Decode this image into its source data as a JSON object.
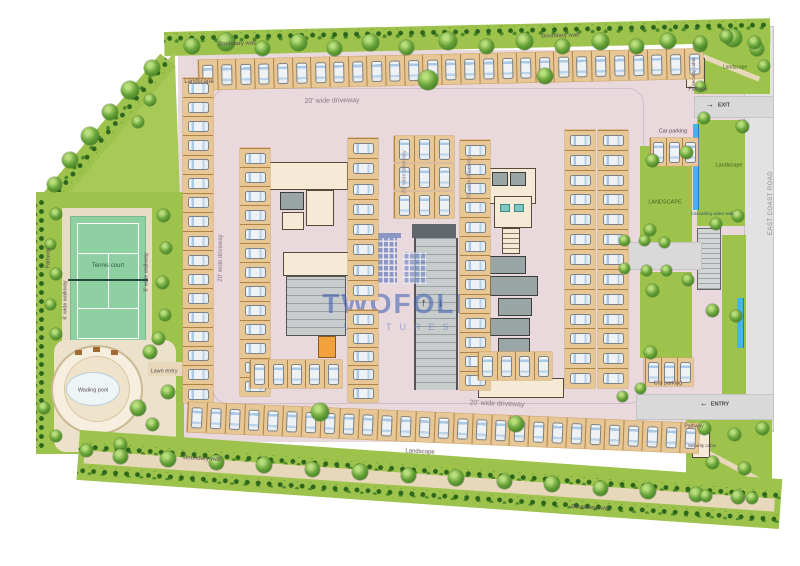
{
  "watermark": {
    "brand": "TWOFOLD",
    "sub": "VENTURES",
    "color": "#3a5db0"
  },
  "road": {
    "label": "EAST COAST ROAD"
  },
  "icons": {
    "arrow_up": "↑",
    "arrow_down": "↓",
    "arrow_right": "→",
    "arrow_left": "←",
    "tree": "tree-icon",
    "car": "car-icon"
  },
  "colors": {
    "paving": "#e9d8dc",
    "stall": "#e7c795",
    "landscape": "#9dc34d",
    "tenniscourt": "#8ed0a2",
    "water": "#46b4e4",
    "building": "#f5ead6",
    "road": "#d9d9d9",
    "watermark": "#3a5db0"
  },
  "labels": [
    {
      "t": "Boundary wall",
      "x": 237,
      "y": 44,
      "r": -1.5
    },
    {
      "t": "Boundary wall",
      "x": 560,
      "y": 36,
      "r": -1.5
    },
    {
      "t": "Landscape",
      "x": 199,
      "y": 82,
      "r": 0
    },
    {
      "t": "20' wide driveway",
      "x": 332,
      "y": 101,
      "r": -1,
      "s": 7,
      "c": "#8a7a80"
    },
    {
      "t": "20' wide driveway",
      "x": 221,
      "y": 258,
      "r": -90,
      "s": 6,
      "c": "#8a7a80"
    },
    {
      "t": "20' wide driveway",
      "x": 405,
      "y": 172,
      "r": -90,
      "s": 5.5,
      "c": "#8a7a80"
    },
    {
      "t": "20' wide driveway",
      "x": 470,
      "y": 178,
      "r": -90,
      "s": 5.5,
      "c": "#8a7a80"
    },
    {
      "t": "20' wide driveway",
      "x": 497,
      "y": 404,
      "r": 2,
      "s": 7,
      "c": "#8a7a80"
    },
    {
      "t": "Pathway",
      "x": 49,
      "y": 258,
      "r": -90,
      "s": 5.5
    },
    {
      "t": "6' wide walkway",
      "x": 66,
      "y": 300,
      "r": -90,
      "s": 5.5
    },
    {
      "t": "6' wide walkway",
      "x": 147,
      "y": 272,
      "r": -90,
      "s": 5.5
    },
    {
      "t": "Tennis court",
      "x": 108,
      "y": 266,
      "r": 0,
      "s": 6,
      "c": "#2f5d46"
    },
    {
      "t": "Wading pool",
      "x": 93,
      "y": 391,
      "r": 0,
      "s": 5.5
    },
    {
      "t": "Lawn entry",
      "x": 164,
      "y": 372,
      "r": 0,
      "s": 5.5
    },
    {
      "t": "Boundary wall",
      "x": 202,
      "y": 459,
      "r": 3
    },
    {
      "t": "Boundary wall",
      "x": 590,
      "y": 508,
      "r": 3
    },
    {
      "t": "Landscape",
      "x": 420,
      "y": 452,
      "r": 3
    },
    {
      "t": "LANDSCAPE",
      "x": 665,
      "y": 203,
      "r": 0,
      "s": 5.5,
      "c": "#3f6220"
    },
    {
      "t": "Landscape",
      "x": 729,
      "y": 166,
      "r": 0,
      "s": 5.5,
      "c": "#3f6220"
    },
    {
      "t": "Cascading water wall",
      "x": 712,
      "y": 214,
      "r": 0,
      "s": 4.5,
      "c": "#33606f"
    },
    {
      "t": "Car parking",
      "x": 673,
      "y": 132,
      "r": 0,
      "s": 5.5
    },
    {
      "t": "Car parking",
      "x": 668,
      "y": 384,
      "r": 0,
      "s": 5.5
    },
    {
      "t": "Pathway",
      "x": 698,
      "y": 90,
      "r": 0,
      "s": 5
    },
    {
      "t": "Pathway",
      "x": 694,
      "y": 427,
      "r": 0,
      "s": 5
    },
    {
      "t": "Security cabin",
      "x": 694,
      "y": 72,
      "r": -90,
      "s": 4.5
    },
    {
      "t": "Security cabin",
      "x": 702,
      "y": 446,
      "r": 0,
      "s": 4.5
    },
    {
      "t": "EXIT",
      "x": 724,
      "y": 106,
      "r": 0,
      "s": 5.5,
      "c": "#444",
      "b": 1
    },
    {
      "t": "ENTRY",
      "x": 720,
      "y": 405,
      "r": 0,
      "s": 5.5,
      "c": "#444",
      "b": 1
    },
    {
      "t": "Landscape",
      "x": 735,
      "y": 68,
      "r": 0,
      "s": 5,
      "c": "#3f6220"
    }
  ],
  "parking_rows": [
    {
      "x": 198,
      "y": 60,
      "w": 505,
      "h": 30,
      "rot": -1.3,
      "n": 27,
      "dir": "v"
    },
    {
      "x": 183,
      "y": 78,
      "w": 30,
      "h": 325,
      "rot": 0,
      "n": 17,
      "dir": "h"
    },
    {
      "x": 240,
      "y": 148,
      "w": 30,
      "h": 248,
      "rot": 0,
      "n": 13,
      "dir": "h"
    },
    {
      "x": 348,
      "y": 138,
      "w": 30,
      "h": 162,
      "rot": 0,
      "n": 8,
      "dir": "h"
    },
    {
      "x": 348,
      "y": 310,
      "w": 30,
      "h": 92,
      "rot": 0,
      "n": 5,
      "dir": "h"
    },
    {
      "x": 394,
      "y": 136,
      "w": 60,
      "h": 26,
      "rot": 0,
      "n": 3,
      "dir": "v"
    },
    {
      "x": 394,
      "y": 164,
      "w": 60,
      "h": 26,
      "rot": 0,
      "n": 3,
      "dir": "v"
    },
    {
      "x": 394,
      "y": 192,
      "w": 60,
      "h": 26,
      "rot": 0,
      "n": 3,
      "dir": "v"
    },
    {
      "x": 460,
      "y": 140,
      "w": 30,
      "h": 250,
      "rot": 0,
      "n": 13,
      "dir": "h"
    },
    {
      "x": 565,
      "y": 130,
      "w": 30,
      "h": 258,
      "rot": 0,
      "n": 13,
      "dir": "h"
    },
    {
      "x": 598,
      "y": 130,
      "w": 30,
      "h": 258,
      "rot": 0,
      "n": 13,
      "dir": "h"
    },
    {
      "x": 250,
      "y": 360,
      "w": 92,
      "h": 28,
      "rot": 0,
      "n": 5,
      "dir": "v"
    },
    {
      "x": 478,
      "y": 352,
      "w": 74,
      "h": 28,
      "rot": 0,
      "n": 4,
      "dir": "v"
    },
    {
      "x": 650,
      "y": 138,
      "w": 48,
      "h": 28,
      "rot": 0,
      "n": 3,
      "dir": "v"
    },
    {
      "x": 645,
      "y": 358,
      "w": 48,
      "h": 28,
      "rot": 0,
      "n": 3,
      "dir": "v"
    },
    {
      "x": 188,
      "y": 402,
      "w": 512,
      "h": 30,
      "rot": 2.4,
      "n": 27,
      "dir": "v"
    }
  ],
  "trees": [
    [
      192,
      46,
      16
    ],
    [
      226,
      42,
      18
    ],
    [
      262,
      48,
      15
    ],
    [
      298,
      42,
      17
    ],
    [
      334,
      48,
      15
    ],
    [
      370,
      42,
      17
    ],
    [
      406,
      47,
      15
    ],
    [
      448,
      41,
      18
    ],
    [
      486,
      46,
      15
    ],
    [
      524,
      41,
      17
    ],
    [
      562,
      46,
      15
    ],
    [
      600,
      41,
      17
    ],
    [
      636,
      46,
      15
    ],
    [
      668,
      41,
      16
    ],
    [
      700,
      45,
      14
    ],
    [
      733,
      38,
      18
    ],
    [
      757,
      49,
      14
    ],
    [
      428,
      80,
      20
    ],
    [
      545,
      76,
      16
    ],
    [
      152,
      68,
      16
    ],
    [
      130,
      90,
      18
    ],
    [
      110,
      112,
      16
    ],
    [
      90,
      136,
      18
    ],
    [
      70,
      160,
      16
    ],
    [
      54,
      184,
      15
    ],
    [
      150,
      100,
      12
    ],
    [
      138,
      122,
      12
    ],
    [
      163,
      215,
      13
    ],
    [
      166,
      248,
      12
    ],
    [
      162,
      282,
      13
    ],
    [
      165,
      315,
      12
    ],
    [
      158,
      338,
      13
    ],
    [
      56,
      214,
      12
    ],
    [
      50,
      244,
      11
    ],
    [
      56,
      274,
      12
    ],
    [
      50,
      304,
      11
    ],
    [
      56,
      334,
      12
    ],
    [
      150,
      352,
      14
    ],
    [
      168,
      392,
      14
    ],
    [
      152,
      424,
      13
    ],
    [
      120,
      444,
      13
    ],
    [
      86,
      450,
      13
    ],
    [
      56,
      436,
      12
    ],
    [
      44,
      408,
      12
    ],
    [
      120,
      456,
      15
    ],
    [
      168,
      459,
      16
    ],
    [
      216,
      462,
      15
    ],
    [
      264,
      465,
      16
    ],
    [
      312,
      469,
      15
    ],
    [
      360,
      472,
      16
    ],
    [
      408,
      475,
      15
    ],
    [
      456,
      478,
      16
    ],
    [
      504,
      481,
      15
    ],
    [
      552,
      484,
      16
    ],
    [
      600,
      488,
      15
    ],
    [
      648,
      491,
      16
    ],
    [
      696,
      494,
      15
    ],
    [
      738,
      497,
      14
    ],
    [
      320,
      412,
      18
    ],
    [
      516,
      424,
      16
    ],
    [
      138,
      408,
      16
    ],
    [
      652,
      160,
      13
    ],
    [
      686,
      152,
      13
    ],
    [
      650,
      230,
      12
    ],
    [
      652,
      290,
      13
    ],
    [
      688,
      280,
      12
    ],
    [
      650,
      352,
      13
    ],
    [
      704,
      118,
      12
    ],
    [
      716,
      224,
      12
    ],
    [
      742,
      126,
      13
    ],
    [
      738,
      216,
      12
    ],
    [
      712,
      310,
      13
    ],
    [
      736,
      316,
      12
    ],
    [
      700,
      42,
      13
    ],
    [
      726,
      36,
      13
    ],
    [
      754,
      42,
      13
    ],
    [
      764,
      66,
      12
    ],
    [
      700,
      86,
      11
    ],
    [
      704,
      428,
      13
    ],
    [
      734,
      434,
      13
    ],
    [
      762,
      428,
      13
    ],
    [
      712,
      462,
      13
    ],
    [
      744,
      468,
      13
    ],
    [
      706,
      496,
      12
    ],
    [
      752,
      498,
      12
    ],
    [
      624,
      240,
      11
    ],
    [
      644,
      240,
      11
    ],
    [
      664,
      242,
      11
    ],
    [
      624,
      268,
      11
    ],
    [
      646,
      270,
      11
    ],
    [
      666,
      270,
      11
    ],
    [
      640,
      388,
      11
    ],
    [
      622,
      396,
      11
    ]
  ]
}
